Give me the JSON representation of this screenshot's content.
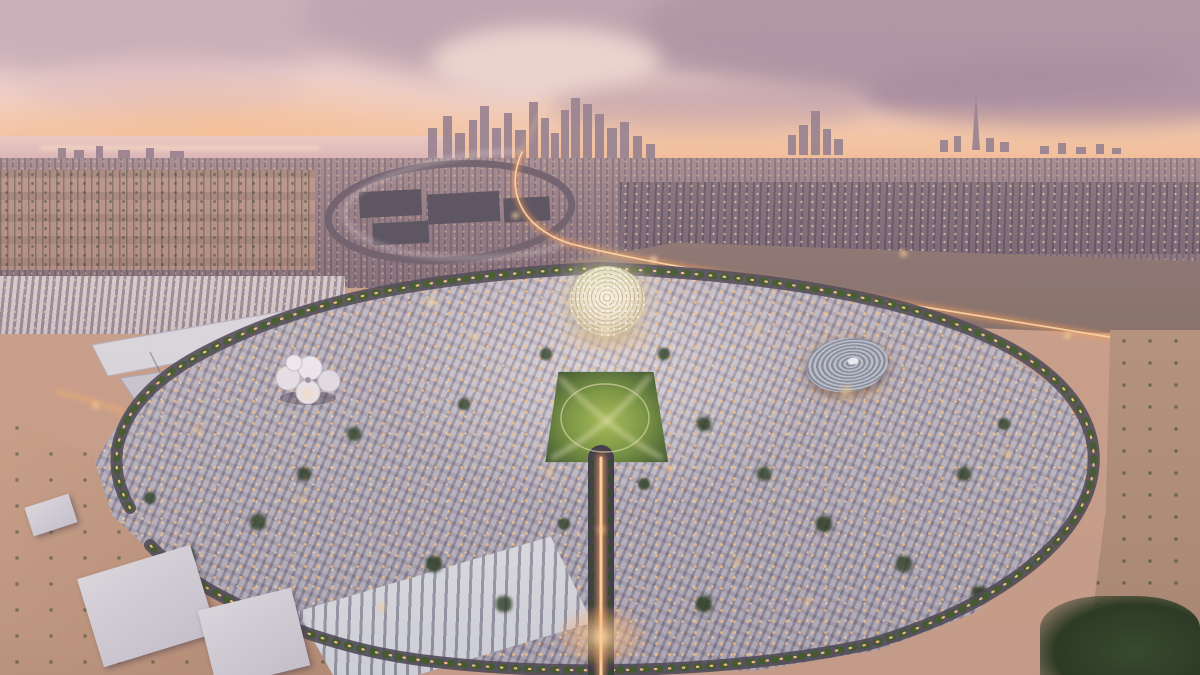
{
  "scene": {
    "type": "aerial-architectural-rendering",
    "caption": "Aerial dusk rendering of the Expo 2020 Dubai site: an oval master plan of lit white-roofed pavilion districts around the glowing Al Wasl dome and a central lawn, ringed by palm-lined roads, with desert sand in the foreground and the hazy Dubai skyline with the Burj Khalifa under a pink sunset sky on the horizon",
    "time_of_day": "dusk",
    "landmarks": {
      "dome": "Al Wasl central lattice dome",
      "disc_pavilion": "circular pavilion with concentric ringed roof",
      "clover_canopy": "white clover-shaped canopy pavilion",
      "central_park": "illuminated central lawn with crossing light paths",
      "boulevard": "lit entry boulevard with tree medians",
      "ring_road": "palm-lined perimeter ring road",
      "exhibition_halls": "long-span white exhibition halls",
      "highway_loop": "elevated highway interchange loop with light trails",
      "skyline": "Dubai skyline with Burj Khalifa",
      "sea": "gulf water at the left horizon",
      "desert": "desert sand with shrubs and warehouses"
    },
    "palette": {
      "sky_top": "#c9afbb",
      "sky_glow": "#f4c9ac",
      "cloud": "#b29aa8",
      "sea": "#e0bcbc",
      "skyline": "#97818f",
      "sprawl": "#8d7880",
      "site_roof": "#c6c2cc",
      "roof_shadow": "#6e6878",
      "warm_light": "#ff9f54",
      "bright_light": "#ffd9a8",
      "headlight": "#f2e7e6",
      "asphalt": "#4e4956",
      "palm": "#42592e",
      "lawn": "#8fae49",
      "tree": "#2e4626",
      "sand": "#c69e85",
      "hall_roof": "#dcdae0",
      "dome_glow": "#f7eed6",
      "disc_ring": "#9aa1af",
      "beam": "#f3edc2",
      "median_green": "#33482a",
      "industrial": "#57505e",
      "station_roof": "#eef0f4"
    }
  }
}
